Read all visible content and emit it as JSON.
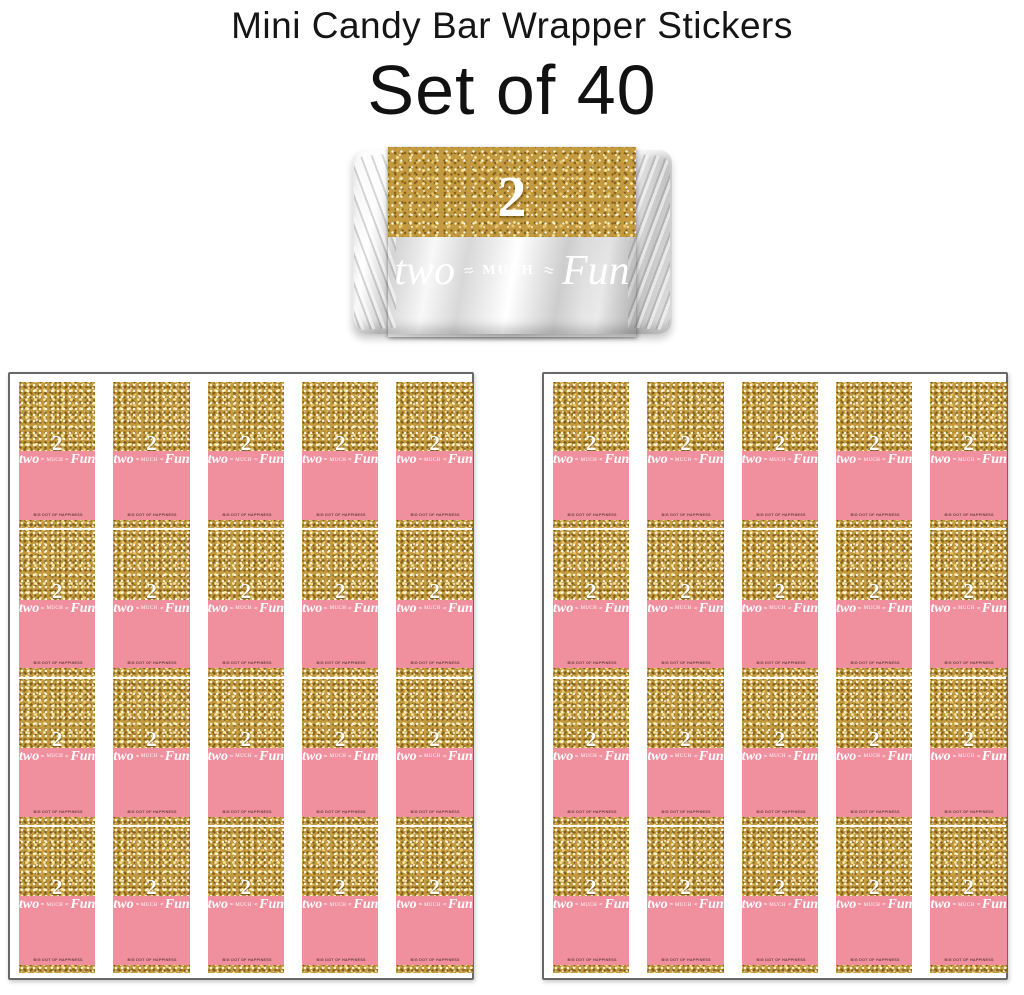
{
  "header": {
    "title": "Mini Candy Bar Wrapper Stickers",
    "subtitle": "Set of 40"
  },
  "wrapper_design": {
    "age_number": "2",
    "phrase": {
      "word_left": "two",
      "accent": "≈",
      "word_middle": "MUCH",
      "word_right": "Fun"
    },
    "brand_line": "BIG DOT OF HAPPINESS",
    "colors": {
      "pink": "#F0909F",
      "gold": "#C49A40",
      "phrase_text": "#FFFFFF"
    }
  },
  "sheets": {
    "count": 2,
    "strips_per_sheet": 5,
    "wrappers_per_strip": 4,
    "total_wrappers": 40
  }
}
